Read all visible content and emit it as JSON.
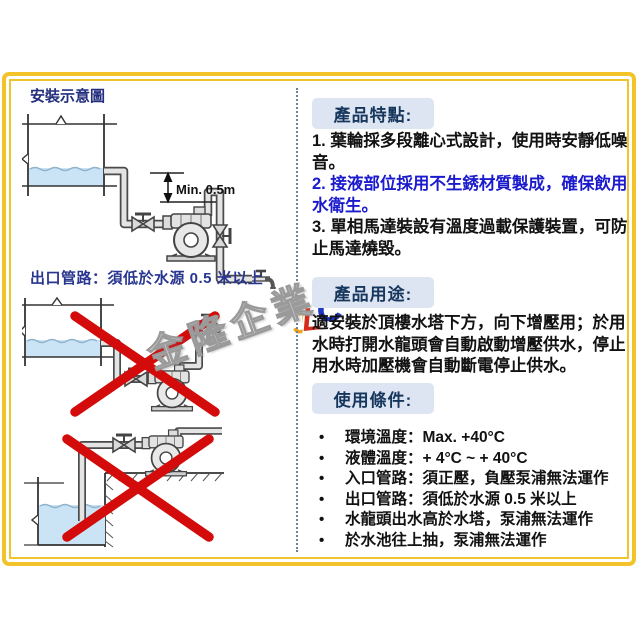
{
  "left_panel": {
    "title": "安裝示意圖",
    "dimension_label": "Min. 0.5m",
    "caption": "出口管路：須低於水源 0.5 米以上"
  },
  "right_panel": {
    "features": {
      "header": "產品特點:",
      "items": [
        {
          "text": "1. 葉輪採多段離心式設計，使用時安靜低噪音。",
          "highlight": false
        },
        {
          "text": "2. 接液部位採用不生銹材質製成，確保飲用水衛生。",
          "highlight": true
        },
        {
          "text": "3. 單相馬達裝設有溫度過載保護裝置，可防止馬達燒毀。",
          "highlight": false
        }
      ]
    },
    "usage": {
      "header": "產品用途:",
      "body": "適安裝於頂樓水塔下方，向下增壓用；於用水時打開水龍頭會自動啟動增壓供水，停止用水時加壓機會自動斷電停止供水。"
    },
    "conditions": {
      "header": "使用條件:",
      "items": [
        "環境溫度：Max. +40°C",
        "液體溫度：+ 4°C ~ + 40°C",
        "入口管路：須正壓，負壓泵浦無法運作",
        "出口管路：須低於水源 0.5 米以上",
        "水龍頭出水高於水塔，泵浦無法運作",
        "於水池往上抽，泵浦無法運作"
      ]
    }
  },
  "watermark": {
    "company": "金隆企業",
    "logo": [
      "J",
      "L",
      "C"
    ]
  },
  "colors": {
    "frame_gold": "#F2C32A",
    "badge_bg": "#DCE5F1",
    "heading_navy": "#17365D",
    "title_blue": "#232F7E",
    "feature_highlight_blue": "#1B1BCD",
    "cross_red": "#D40B0B",
    "water_blue": "#CBE4F5"
  }
}
